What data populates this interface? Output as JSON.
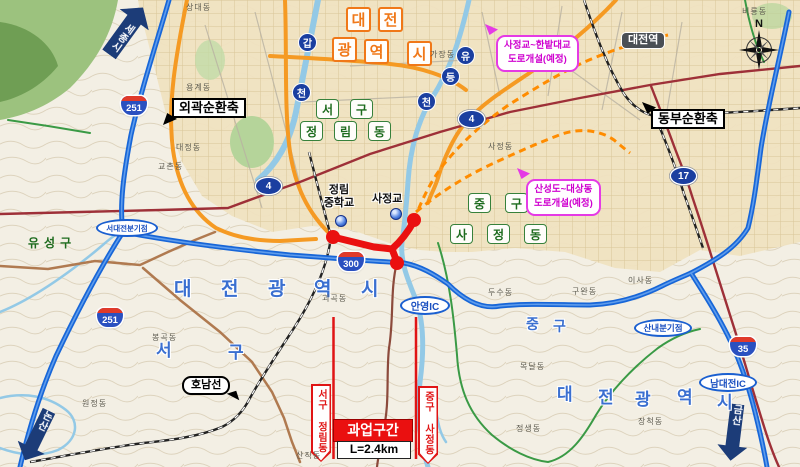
{
  "direction_arrows": {
    "sejong": "세종시",
    "nonsan": "논산",
    "geumsan": "금산"
  },
  "axes": {
    "outer_ring": "외곽순환축",
    "east_ring": "동부순환축"
  },
  "city_chars": [
    "대",
    "전",
    "광",
    "역",
    "시"
  ],
  "rivers": {
    "gapcheon": [
      "갑",
      "천"
    ],
    "yudeungcheon": [
      "유",
      "등",
      "천"
    ]
  },
  "district_boxed": {
    "seo_gu": [
      "서",
      "구"
    ],
    "jeongnim_dong": [
      "정",
      "림",
      "동"
    ],
    "jung_gu": [
      "중",
      "구"
    ],
    "sajeong_dong": [
      "사",
      "정",
      "동"
    ]
  },
  "district_plain": {
    "yuseong_gu": "유성구",
    "seo_gu": [
      "서",
      "구"
    ],
    "jung_gu": [
      "중",
      "구"
    ]
  },
  "station": "대전역",
  "planned": {
    "a_line1": "사정교~한밭대교",
    "a_line2": "도로개설(예정)",
    "b_line1": "산성도~대상동",
    "b_line2": "도로개설(예정)"
  },
  "shields": {
    "hw251": "251",
    "hw300": "300",
    "hw35": "35",
    "n4": "4",
    "n17": "17"
  },
  "nodes": {
    "seodaejeon_jct": "서대전분기점",
    "anyeong_ic": "안영IC",
    "sannae_jct": "산내분기점",
    "namdaejeon_ic": "남대전IC"
  },
  "rail": {
    "honam_line": "호남선"
  },
  "pois": {
    "school_l1": "정림",
    "school_l2": "중학교",
    "bridge": "사정교"
  },
  "project": {
    "title": "과업구간",
    "length": "L=2.4km",
    "left_boundary": "서구 정림동",
    "right_boundary": "중구 사정동"
  },
  "compass": {
    "north": "N"
  },
  "towns": [
    {
      "t": "상대동",
      "x": 186,
      "y": 2
    },
    {
      "t": "비룡동",
      "x": 742,
      "y": 6
    },
    {
      "t": "가장동",
      "x": 430,
      "y": 49
    },
    {
      "t": "용계동",
      "x": 186,
      "y": 82
    },
    {
      "t": "사정동",
      "x": 488,
      "y": 141
    },
    {
      "t": "대정동",
      "x": 176,
      "y": 142
    },
    {
      "t": "교촌동",
      "x": 158,
      "y": 161
    },
    {
      "t": "이사동",
      "x": 628,
      "y": 275
    },
    {
      "t": "구완동",
      "x": 572,
      "y": 286
    },
    {
      "t": "두수동",
      "x": 488,
      "y": 287
    },
    {
      "t": "괴곡동",
      "x": 322,
      "y": 293
    },
    {
      "t": "봉곡동",
      "x": 152,
      "y": 332
    },
    {
      "t": "목달동",
      "x": 520,
      "y": 361
    },
    {
      "t": "원정동",
      "x": 82,
      "y": 398
    },
    {
      "t": "장척동",
      "x": 638,
      "y": 416
    },
    {
      "t": "정생동",
      "x": 516,
      "y": 423
    },
    {
      "t": "산직동",
      "x": 296,
      "y": 450
    }
  ]
}
